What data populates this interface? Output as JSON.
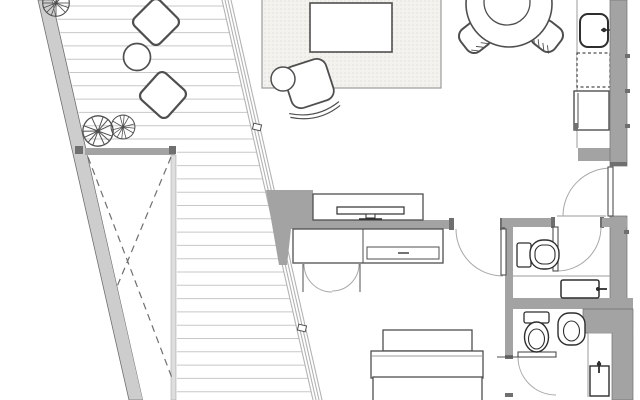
{
  "document": {
    "kind": "architectural-floor-plan",
    "visible_text": [],
    "orientation": "top-down plan view, apartment with slanted terrace"
  },
  "colors": {
    "background": "#ffffff",
    "wall_fill": "#a3a3a3",
    "wall_dark": "#6f6f6f",
    "terrace_wall_fill": "#cdcdcd",
    "void_band_fill": "#dedede",
    "furniture_line": "#4f4f4f",
    "fixture_line": "#2e2e2e",
    "thin_line": "#9b9b9b",
    "deck_line": "#c7c7c7",
    "glass_line": "#b3b3b3",
    "dash_line": "#6f6f6f",
    "door_arc": "#a8a8a8",
    "rug_fill": "#f3f2ee",
    "rug_dot": "#d8d5cc"
  },
  "floorplan": {
    "canvas": {
      "width": 640,
      "height": 400
    },
    "deck": {
      "spacing": 13.3,
      "y_start": 6,
      "y_end": 395,
      "slope": 0.2275,
      "wall_inner_x0": 53,
      "glass_x0": 222,
      "void_top_y": 152,
      "void_right_x": 177
    },
    "rooms": [
      "terrace",
      "living-room",
      "dining-area",
      "kitchen",
      "entry-hall",
      "bathroom-upper",
      "bathroom-lower",
      "bedroom"
    ],
    "furniture": {
      "terrace": [
        "deck-boards",
        "tree",
        "tree",
        "tree",
        "pouf",
        "pouf",
        "round-side-table",
        "void-with-cross-bracing"
      ],
      "living_room": [
        "area-rug",
        "coffee-table",
        "armchair",
        "round-ottoman",
        "tv-sideboard",
        "tv"
      ],
      "dining_area": [
        "round-dining-table",
        "dining-chair",
        "dining-chair"
      ],
      "kitchen": [
        "counter",
        "sink-with-faucet",
        "cooktop-dashed",
        "oven",
        "counter-return"
      ],
      "bathroom_upper": [
        "toilet",
        "vanity-washbasin",
        "door"
      ],
      "bathroom_lower": [
        "toilet",
        "bidet",
        "washbasin",
        "door"
      ],
      "bedroom": [
        "double-bed",
        "pillow",
        "wardrobe-sideboard",
        "wardrobe-double-doors",
        "door"
      ],
      "doors": [
        "entry-door",
        "bedroom-door",
        "bathroom-upper-door",
        "bathroom-lower-door"
      ]
    }
  }
}
